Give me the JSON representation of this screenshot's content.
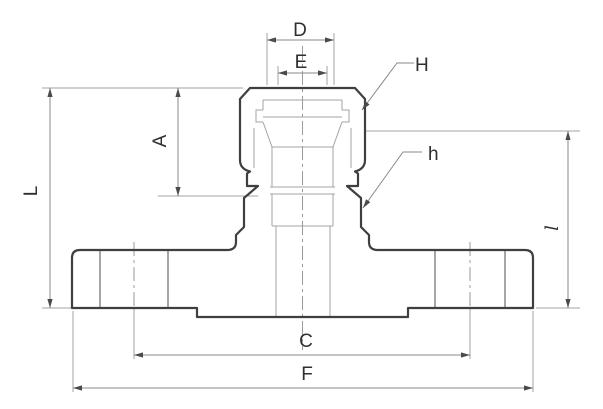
{
  "diagram": {
    "title": "flanged-union-fitting-cross-section",
    "labels": {
      "D": "D",
      "E": "E",
      "H": "H",
      "A": "A",
      "L": "L",
      "h": "h",
      "C": "C",
      "F": "F",
      "l": "l"
    },
    "colors": {
      "outline": "#3f3f3f",
      "thin": "#a3a3a3",
      "dimension": "#8a8a8a",
      "centerline": "#9a9a9a",
      "bolt_hole": "#6b6b6b",
      "arrow": "#4a4a4a",
      "label": "#2f2f2f",
      "background": "#ffffff"
    }
  }
}
